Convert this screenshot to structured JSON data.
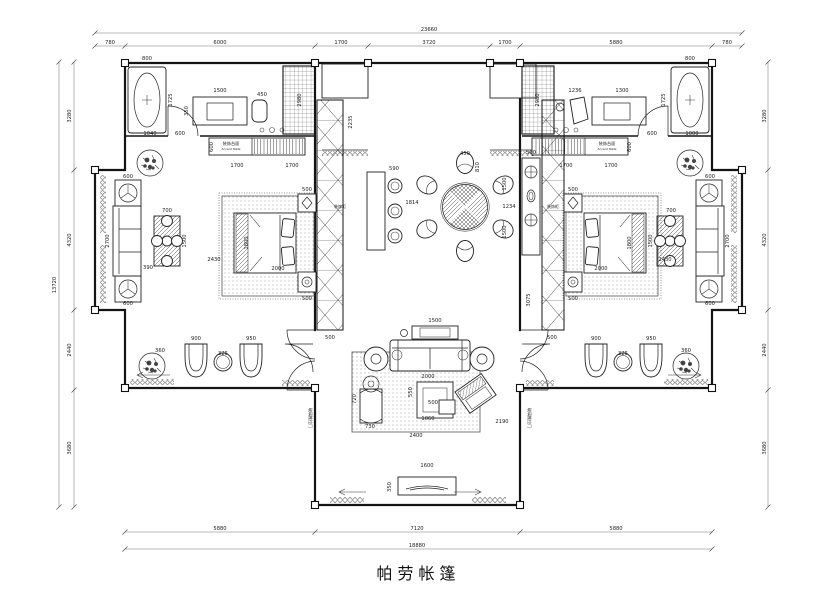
{
  "title": {
    "text": "帕劳帐篷"
  },
  "dim_labels": [
    {
      "t": "23660",
      "x": 429,
      "y": 31
    },
    {
      "t": "780",
      "x": 110,
      "y": 44
    },
    {
      "t": "6000",
      "x": 220,
      "y": 44
    },
    {
      "t": "1700",
      "x": 341,
      "y": 44
    },
    {
      "t": "3720",
      "x": 429,
      "y": 44
    },
    {
      "t": "1700",
      "x": 505,
      "y": 44
    },
    {
      "t": "5880",
      "x": 616,
      "y": 44
    },
    {
      "t": "780",
      "x": 727,
      "y": 44
    },
    {
      "t": "5880",
      "x": 220,
      "y": 530
    },
    {
      "t": "7120",
      "x": 417,
      "y": 530
    },
    {
      "t": "5880",
      "x": 616,
      "y": 530
    },
    {
      "t": "18880",
      "x": 417,
      "y": 547
    },
    {
      "t": "3280",
      "x": 71,
      "y": 116,
      "r": -90
    },
    {
      "t": "4320",
      "x": 71,
      "y": 240,
      "r": -90
    },
    {
      "t": "2440",
      "x": 71,
      "y": 350,
      "r": -90
    },
    {
      "t": "3680",
      "x": 71,
      "y": 448,
      "r": -90
    },
    {
      "t": "13720",
      "x": 56,
      "y": 285,
      "r": -90
    },
    {
      "t": "3280",
      "x": 766,
      "y": 116,
      "r": -90
    },
    {
      "t": "4320",
      "x": 766,
      "y": 240,
      "r": -90
    },
    {
      "t": "2440",
      "x": 766,
      "y": 350,
      "r": -90
    },
    {
      "t": "3680",
      "x": 766,
      "y": 448,
      "r": -90
    },
    {
      "t": "800",
      "x": 147,
      "y": 60
    },
    {
      "t": "1725",
      "x": 172,
      "y": 100,
      "r": -90
    },
    {
      "t": "1040",
      "x": 150,
      "y": 135
    },
    {
      "t": "600",
      "x": 180,
      "y": 135
    },
    {
      "t": "1500",
      "x": 220,
      "y": 92
    },
    {
      "t": "350",
      "x": 188,
      "y": 111,
      "r": -90
    },
    {
      "t": "450",
      "x": 262,
      "y": 96
    },
    {
      "t": "2980",
      "x": 301,
      "y": 100,
      "r": -90
    },
    {
      "t": "600",
      "x": 213,
      "y": 147,
      "r": -90
    },
    {
      "t": "1700",
      "x": 237,
      "y": 167
    },
    {
      "t": "1700",
      "x": 292,
      "y": 167
    },
    {
      "t": "装饰台面",
      "x": 231,
      "y": 145,
      "s": 4.2,
      "n": "accent-table-label-cn"
    },
    {
      "t": "Accent Table",
      "x": 231,
      "y": 150,
      "s": 3,
      "n": "accent-table-label-en"
    },
    {
      "t": "500",
      "x": 307,
      "y": 191
    },
    {
      "t": "1800",
      "x": 248,
      "y": 243,
      "r": -90
    },
    {
      "t": "2000",
      "x": 278,
      "y": 270
    },
    {
      "t": "2430",
      "x": 214,
      "y": 261
    },
    {
      "t": "500",
      "x": 307,
      "y": 300
    },
    {
      "t": "500",
      "x": 330,
      "y": 339
    },
    {
      "t": "装饰柜",
      "x": 340,
      "y": 208,
      "s": 4,
      "n": "cabinet-label"
    },
    {
      "t": "600",
      "x": 128,
      "y": 178
    },
    {
      "t": "2700",
      "x": 109,
      "y": 241,
      "r": -90
    },
    {
      "t": "700",
      "x": 167,
      "y": 212
    },
    {
      "t": "1500",
      "x": 186,
      "y": 241,
      "r": -90
    },
    {
      "t": "390",
      "x": 148,
      "y": 269
    },
    {
      "t": "600",
      "x": 128,
      "y": 305
    },
    {
      "t": "360",
      "x": 160,
      "y": 352
    },
    {
      "t": "900",
      "x": 196,
      "y": 340
    },
    {
      "t": "950",
      "x": 251,
      "y": 340
    },
    {
      "t": "325",
      "x": 223,
      "y": 355
    },
    {
      "t": "2235",
      "x": 352,
      "y": 122,
      "r": -90
    },
    {
      "t": "590",
      "x": 394,
      "y": 170
    },
    {
      "t": "450",
      "x": 465,
      "y": 155
    },
    {
      "t": "810",
      "x": 479,
      "y": 167,
      "r": -90
    },
    {
      "t": "1814",
      "x": 412,
      "y": 204
    },
    {
      "t": "1234",
      "x": 509,
      "y": 208
    },
    {
      "t": "1500",
      "x": 506,
      "y": 184,
      "r": -90
    },
    {
      "t": "1500",
      "x": 506,
      "y": 232,
      "r": -90
    },
    {
      "t": "500",
      "x": 531,
      "y": 154
    },
    {
      "t": "3075",
      "x": 530,
      "y": 300,
      "r": -90
    },
    {
      "t": "装饰柜",
      "x": 553,
      "y": 208,
      "s": 4,
      "n": "cabinet-label"
    },
    {
      "t": "1500",
      "x": 435,
      "y": 322
    },
    {
      "t": "2000",
      "x": 428,
      "y": 378
    },
    {
      "t": "550",
      "x": 412,
      "y": 392,
      "r": -90
    },
    {
      "t": "500",
      "x": 433,
      "y": 404
    },
    {
      "t": "1060",
      "x": 428,
      "y": 420
    },
    {
      "t": "720",
      "x": 356,
      "y": 399,
      "r": -90
    },
    {
      "t": "730",
      "x": 370,
      "y": 428
    },
    {
      "t": "2400",
      "x": 416,
      "y": 437
    },
    {
      "t": "2190",
      "x": 502,
      "y": 423
    },
    {
      "t": "1600",
      "x": 427,
      "y": 467
    },
    {
      "t": "350",
      "x": 391,
      "y": 487,
      "r": -90
    },
    {
      "t": "900",
      "x": 596,
      "y": 340
    },
    {
      "t": "950",
      "x": 651,
      "y": 340
    },
    {
      "t": "325",
      "x": 623,
      "y": 355
    },
    {
      "t": "360",
      "x": 686,
      "y": 352
    },
    {
      "t": "2980",
      "x": 539,
      "y": 100,
      "r": -90
    },
    {
      "t": "1236",
      "x": 575,
      "y": 92
    },
    {
      "t": "1300",
      "x": 622,
      "y": 92
    },
    {
      "t": "800",
      "x": 690,
      "y": 60
    },
    {
      "t": "1725",
      "x": 665,
      "y": 100,
      "r": -90
    },
    {
      "t": "600",
      "x": 652,
      "y": 135
    },
    {
      "t": "1000",
      "x": 692,
      "y": 135
    },
    {
      "t": "600",
      "x": 631,
      "y": 147,
      "r": -90
    },
    {
      "t": "1700",
      "x": 566,
      "y": 167
    },
    {
      "t": "1700",
      "x": 611,
      "y": 167
    },
    {
      "t": "装饰台面",
      "x": 607,
      "y": 145,
      "s": 4.2,
      "n": "accent-table-label-cn"
    },
    {
      "t": "Accent Table",
      "x": 607,
      "y": 150,
      "s": 3,
      "n": "accent-table-label-en"
    },
    {
      "t": "500",
      "x": 573,
      "y": 191
    },
    {
      "t": "1800",
      "x": 631,
      "y": 243,
      "r": -90
    },
    {
      "t": "2000",
      "x": 601,
      "y": 270
    },
    {
      "t": "2430",
      "x": 665,
      "y": 261
    },
    {
      "t": "500",
      "x": 573,
      "y": 300
    },
    {
      "t": "500",
      "x": 552,
      "y": 339
    },
    {
      "t": "600",
      "x": 710,
      "y": 178
    },
    {
      "t": "2700",
      "x": 729,
      "y": 241,
      "r": -90
    },
    {
      "t": "700",
      "x": 671,
      "y": 212
    },
    {
      "t": "1500",
      "x": 652,
      "y": 241,
      "r": -90
    },
    {
      "t": "600",
      "x": 710,
      "y": 305
    },
    {
      "t": "玻璃推拉门",
      "x": 309,
      "y": 418,
      "r": 90,
      "s": 4,
      "n": "door-note"
    },
    {
      "t": "玻璃推拉门",
      "x": 528,
      "y": 418,
      "r": 90,
      "s": 4,
      "n": "door-note"
    }
  ]
}
